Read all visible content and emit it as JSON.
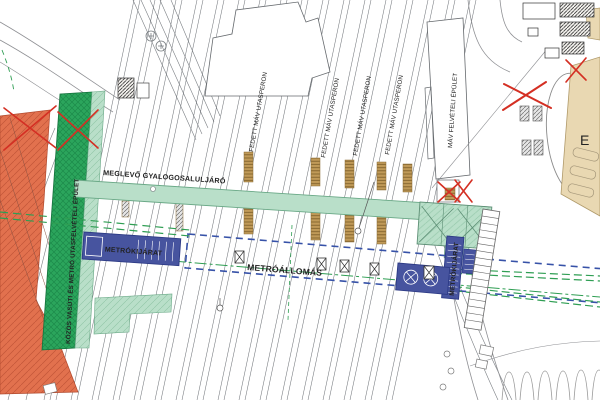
{
  "title": "Railway and metro station site plan",
  "labels": {
    "underpass": "MEGLEVŐ GYALOGOSALULJÁRÓ",
    "station_building": "KÖZÖS VASÚTI ÉS METRÓ UTASFELVÉTELI ÉPÜLET",
    "metro_station": "METRÓÁLLOMÁS",
    "metro_exit_left": "METRÓKIJÁRAT",
    "metro_exit_right": "METRÓKIJÁRAT",
    "platform_1": "FEDETT MÁV UTASPERON",
    "platform_2": "FEDETT MÁV UTASPERON",
    "platform_3": "FEDETT MÁV UTASPERON",
    "platform_4": "FEDETT MÁV UTASPERON",
    "reception_building": "MÁV FELVÉTELI ÉPÜLET",
    "partial_building_letter": "E"
  },
  "colors": {
    "walkway_mint": "#b9dfc9",
    "station_building_green": "#2ba55c",
    "demolition_orange": "#e2714e",
    "metro_blue": "#47549f",
    "station_outline_blue": "#3752a8",
    "metro_line_green": "#2f9e53",
    "adjacent_building_beige": "#e9d8b2",
    "platform_stair_tan": "#c09a58",
    "markup_red": "#d42f23"
  },
  "symbols": {
    "crossed_box": "shaft-symbol",
    "red_x": "deleted-element-mark",
    "ladder": "stairs-symbol",
    "circle_cross": "vent-shaft-symbol"
  }
}
